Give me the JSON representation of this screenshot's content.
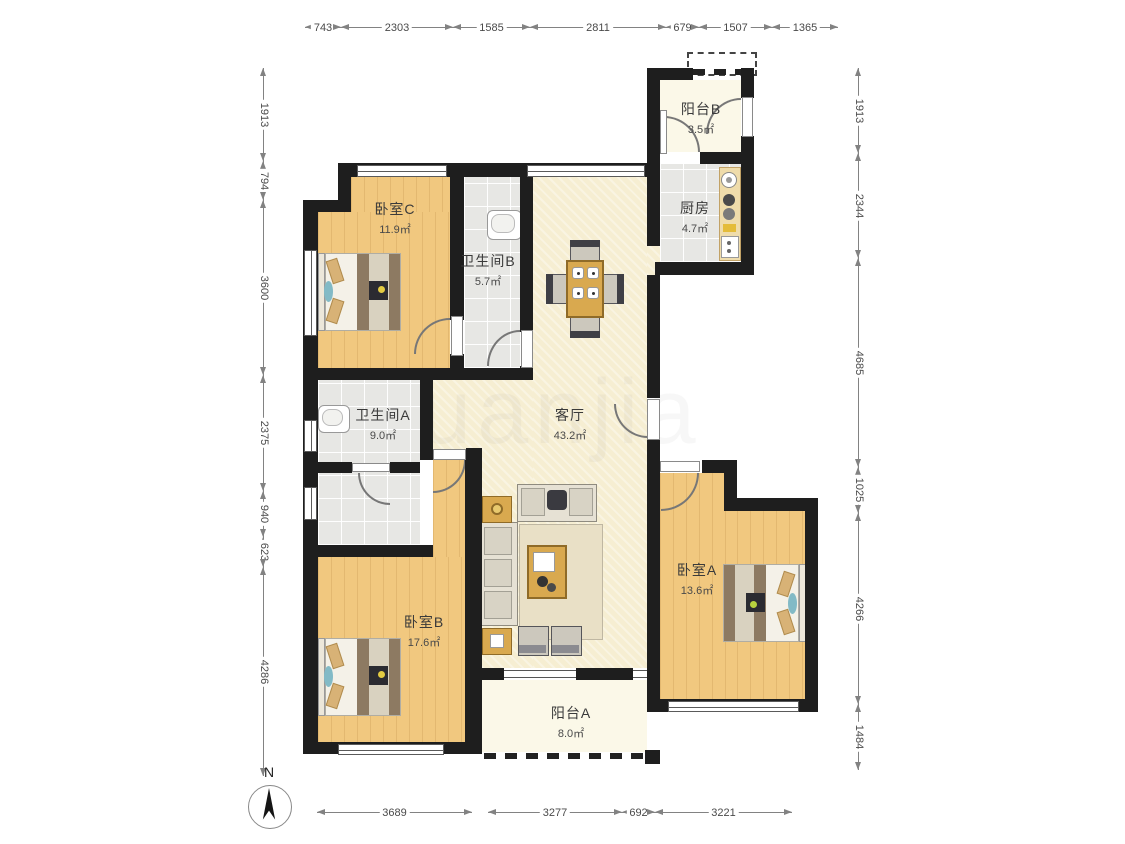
{
  "rooms": [
    {
      "name": "阳台B",
      "area": "3.5㎡"
    },
    {
      "name": "厨房",
      "area": "4.7㎡"
    },
    {
      "name": "卧室C",
      "area": "11.9㎡"
    },
    {
      "name": "卫生间B",
      "area": "5.7㎡"
    },
    {
      "name": "客厅",
      "area": "43.2㎡"
    },
    {
      "name": "卫生间A",
      "area": "9.0㎡"
    },
    {
      "name": "卧室B",
      "area": "17.6㎡"
    },
    {
      "name": "卧室A",
      "area": "13.6㎡"
    },
    {
      "name": "阳台A",
      "area": "8.0㎡"
    }
  ],
  "dims": {
    "top": [
      "743",
      "2303",
      "1585",
      "2811",
      "679",
      "1507",
      "1365"
    ],
    "left": [
      "1913",
      "794",
      "3600",
      "2375",
      "940",
      "623",
      "4286"
    ],
    "right": [
      "1913",
      "2344",
      "4685",
      "1025",
      "4266",
      "1484"
    ],
    "bottom": [
      "3689",
      "3277",
      "692",
      "3221"
    ]
  },
  "compass": {
    "label": "N"
  },
  "watermark": "uanjia",
  "colors": {
    "wall": "#1e1e1e",
    "wood": "#f1c87f",
    "tile": "#e7e7e4",
    "living": "#f6eed2",
    "balcony": "#fbf8e8",
    "counter": "#efdcab"
  }
}
